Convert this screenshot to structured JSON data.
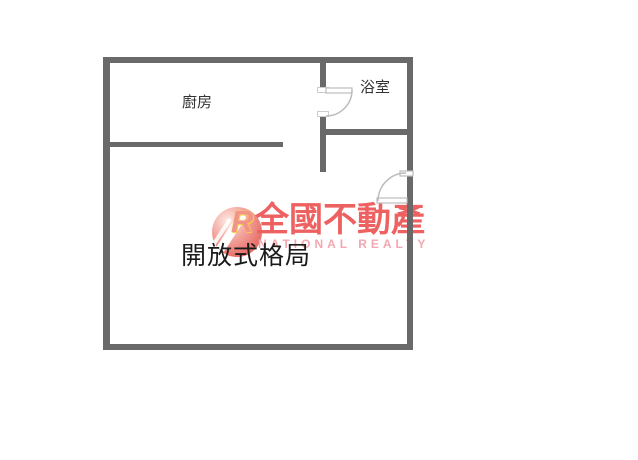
{
  "rooms": {
    "kitchen_label": "廚房",
    "bathroom_label": "浴室",
    "main_label": "開放式格局"
  },
  "watermark": {
    "brand_cn": "全國不動產",
    "brand_en": "NATIONAL REALTY",
    "logo_letter": "R"
  },
  "colors": {
    "wall": "#696969",
    "door_line": "#bcbcbc",
    "door_fill": "#ffffff",
    "room_label": "#333333",
    "main_label": "#1b1b1b",
    "watermark_red": "#ee6161",
    "watermark_pink": "#f2a8b0",
    "background": "#ffffff"
  }
}
